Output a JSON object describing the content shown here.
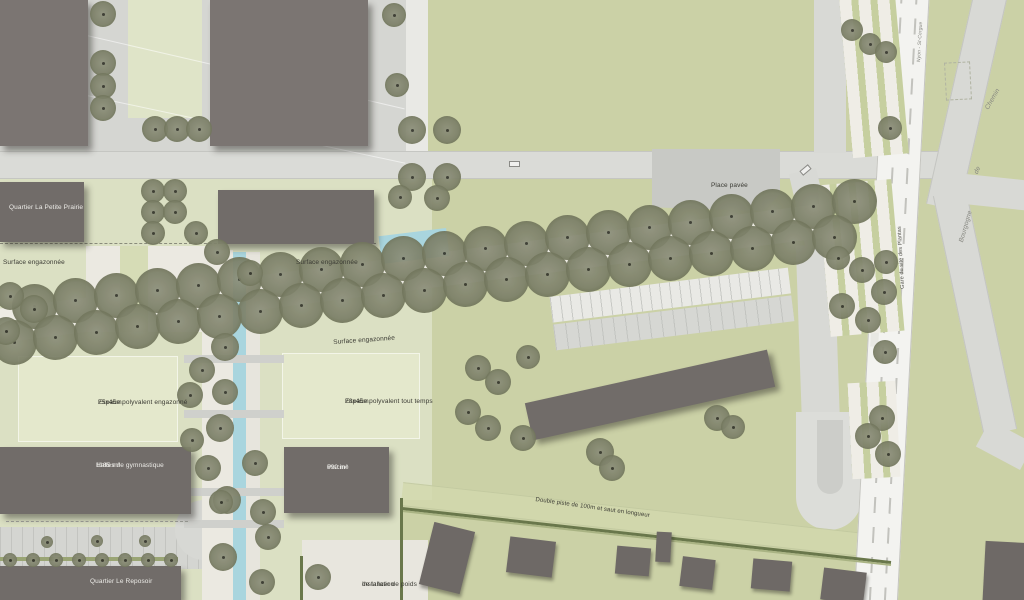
{
  "labels": {
    "place_pavee": "Place pavée",
    "surface_1": "Surface engazonnée",
    "surface_2": "Surface engazonnée",
    "surface_left": "Surface engazonnée",
    "quartier_petite_prairie": "Quartier La Petite Prairie",
    "espace_engazonne_1": "Espace polyvalent engazonné",
    "espace_engazonne_2": "25x45m.",
    "espace_tout_temps_1": "Espace polyvalent tout temps",
    "espace_tout_temps_2": "28x45m.",
    "halles_1": "Halles de gymnastique",
    "halles_2": "1185 m²",
    "piscine_1": "Piscine",
    "piscine_2": "690 m²",
    "quartier_reposoir": "Quartier Le Reposoir",
    "installation_1": "Installation",
    "installation_2": "de lancer de poids",
    "double_piste": "Double piste de 100m et saut en longueur",
    "gare": "Gare du site des Plantas",
    "ligne_ferroviaire": "Nyon - St-Cergue",
    "rue_chemin": "Chemin",
    "rue_de": "de",
    "rue_bourgogne": "Bourgogne"
  },
  "palette": {
    "field_green": "#cbd1a6",
    "campus_green": "#dbe0c3",
    "panel_green": "#e4e8cc",
    "pavement": "#d5d6d2",
    "road": "#dadbd7",
    "gravel": "#ebe9e1",
    "rail_white": "#f3f3f0",
    "building_dark": "#716c69",
    "water_blue": "#a9d5de",
    "tree_olive": "#7c8068",
    "hedge_green": "#69774b"
  },
  "map": {
    "trees": [
      [
        34,
        306,
        45
      ],
      [
        75,
        300,
        45
      ],
      [
        116,
        295,
        45
      ],
      [
        157,
        290,
        45
      ],
      [
        198,
        285,
        45
      ],
      [
        239,
        279,
        45
      ],
      [
        280,
        274,
        45
      ],
      [
        321,
        269,
        45
      ],
      [
        362,
        264,
        45
      ],
      [
        403,
        258,
        45
      ],
      [
        444,
        253,
        45
      ],
      [
        485,
        248,
        45
      ],
      [
        526,
        243,
        45
      ],
      [
        567,
        237,
        45
      ],
      [
        608,
        232,
        45
      ],
      [
        649,
        227,
        45
      ],
      [
        690,
        222,
        45
      ],
      [
        731,
        216,
        45
      ],
      [
        772,
        211,
        45
      ],
      [
        813,
        206,
        45
      ],
      [
        854,
        201,
        45
      ],
      [
        14,
        342,
        45
      ],
      [
        55,
        337,
        45
      ],
      [
        96,
        332,
        45
      ],
      [
        137,
        326,
        45
      ],
      [
        178,
        321,
        45
      ],
      [
        219,
        316,
        45
      ],
      [
        260,
        311,
        45
      ],
      [
        301,
        305,
        45
      ],
      [
        342,
        300,
        45
      ],
      [
        383,
        295,
        45
      ],
      [
        424,
        290,
        45
      ],
      [
        465,
        284,
        45
      ],
      [
        506,
        279,
        45
      ],
      [
        547,
        274,
        45
      ],
      [
        588,
        269,
        45
      ],
      [
        629,
        264,
        45
      ],
      [
        670,
        258,
        45
      ],
      [
        711,
        253,
        45
      ],
      [
        752,
        248,
        45
      ],
      [
        793,
        242,
        45
      ],
      [
        834,
        237,
        45
      ],
      [
        103,
        14,
        26
      ],
      [
        103,
        63,
        26
      ],
      [
        103,
        86,
        26
      ],
      [
        103,
        108,
        26
      ],
      [
        155,
        129,
        26
      ],
      [
        177,
        129,
        26
      ],
      [
        199,
        129,
        26
      ],
      [
        394,
        15,
        24
      ],
      [
        397,
        85,
        24
      ],
      [
        412,
        130,
        28
      ],
      [
        447,
        130,
        28
      ],
      [
        412,
        177,
        28
      ],
      [
        447,
        177,
        28
      ],
      [
        437,
        198,
        26
      ],
      [
        400,
        197,
        24
      ],
      [
        852,
        30,
        22
      ],
      [
        870,
        44,
        22
      ],
      [
        886,
        52,
        22
      ],
      [
        890,
        128,
        24
      ],
      [
        884,
        292,
        26
      ],
      [
        838,
        258,
        24
      ],
      [
        862,
        270,
        26
      ],
      [
        886,
        262,
        24
      ],
      [
        842,
        306,
        26
      ],
      [
        868,
        320,
        26
      ],
      [
        885,
        352,
        24
      ],
      [
        882,
        418,
        26
      ],
      [
        868,
        436,
        26
      ],
      [
        888,
        454,
        26
      ],
      [
        153,
        191,
        24
      ],
      [
        175,
        191,
        24
      ],
      [
        153,
        212,
        24
      ],
      [
        175,
        212,
        24
      ],
      [
        153,
        233,
        24
      ],
      [
        196,
        233,
        24
      ],
      [
        10,
        296,
        28
      ],
      [
        34,
        309,
        28
      ],
      [
        6,
        331,
        28
      ],
      [
        217,
        252,
        26
      ],
      [
        250,
        273,
        26
      ],
      [
        225,
        347,
        28
      ],
      [
        202,
        370,
        26
      ],
      [
        190,
        395,
        26
      ],
      [
        225,
        392,
        26
      ],
      [
        220,
        428,
        28
      ],
      [
        192,
        440,
        24
      ],
      [
        208,
        468,
        26
      ],
      [
        255,
        463,
        26
      ],
      [
        227,
        500,
        28
      ],
      [
        263,
        512,
        26
      ],
      [
        268,
        537,
        26
      ],
      [
        223,
        557,
        28
      ],
      [
        262,
        582,
        26
      ],
      [
        221,
        502,
        24
      ],
      [
        478,
        368,
        26
      ],
      [
        498,
        382,
        26
      ],
      [
        528,
        357,
        24
      ],
      [
        468,
        412,
        26
      ],
      [
        488,
        428,
        26
      ],
      [
        523,
        438,
        26
      ],
      [
        600,
        452,
        28
      ],
      [
        612,
        468,
        26
      ],
      [
        717,
        418,
        26
      ],
      [
        733,
        427,
        24
      ],
      [
        318,
        577,
        26
      ],
      [
        47,
        542,
        12
      ],
      [
        97,
        541,
        12
      ],
      [
        145,
        541,
        12
      ],
      [
        10,
        560,
        14
      ],
      [
        33,
        560,
        14
      ],
      [
        56,
        560,
        14
      ],
      [
        79,
        560,
        14
      ],
      [
        102,
        560,
        14
      ],
      [
        125,
        560,
        14
      ],
      [
        148,
        560,
        14
      ],
      [
        171,
        560,
        14
      ]
    ],
    "houses": [
      [
        447,
        558,
        42,
        64,
        14
      ],
      [
        531,
        557,
        46,
        36,
        7
      ],
      [
        633,
        561,
        34,
        28,
        5
      ],
      [
        663,
        547,
        15,
        30,
        3
      ],
      [
        697,
        573,
        33,
        30,
        7
      ],
      [
        771,
        575,
        39,
        30,
        5
      ],
      [
        843,
        586,
        43,
        32,
        7
      ],
      [
        1006,
        573,
        44,
        62,
        3
      ]
    ]
  }
}
